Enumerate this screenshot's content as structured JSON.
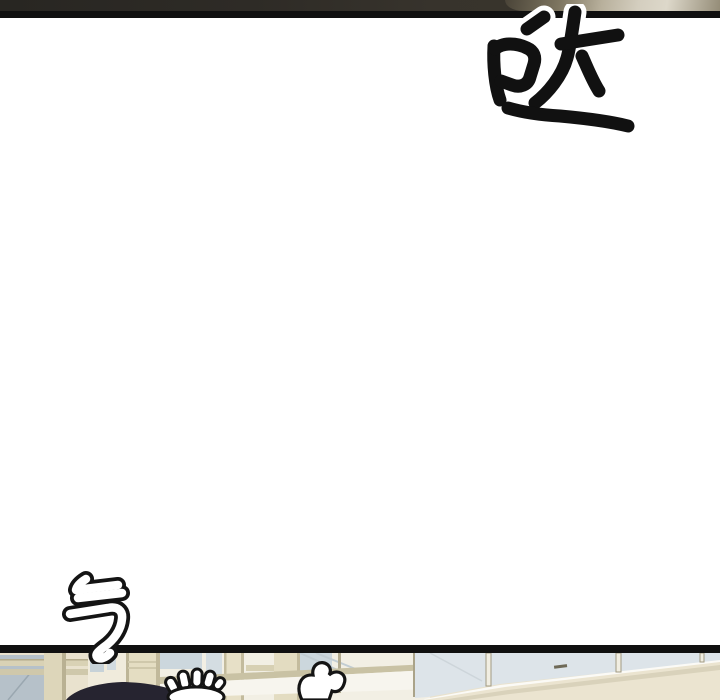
{
  "comic": {
    "sfx_top_right": "哒",
    "sfx_bottom_left": "气",
    "panel_alts": {
      "previous_panel": "dark underside of previous panel with blurred tan object at right",
      "main_panel": "blank white flash panel",
      "next_panel": "top sliver of next panel: mall interior with beige columns, glass railings, black hair and two white cartoon hands"
    }
  },
  "colors": {
    "page_bg": "#ffffff",
    "panel_border": "#101010",
    "prev_panel_dark": "#2e2b26",
    "blur_object_tan": "#cfc8b6",
    "scene_beige": "#e9e2ce",
    "scene_glass_blue": "#b6c1c9",
    "scene_cream": "#ebe4d0",
    "hair_black": "#262430",
    "sfx_ink": "#111111"
  }
}
